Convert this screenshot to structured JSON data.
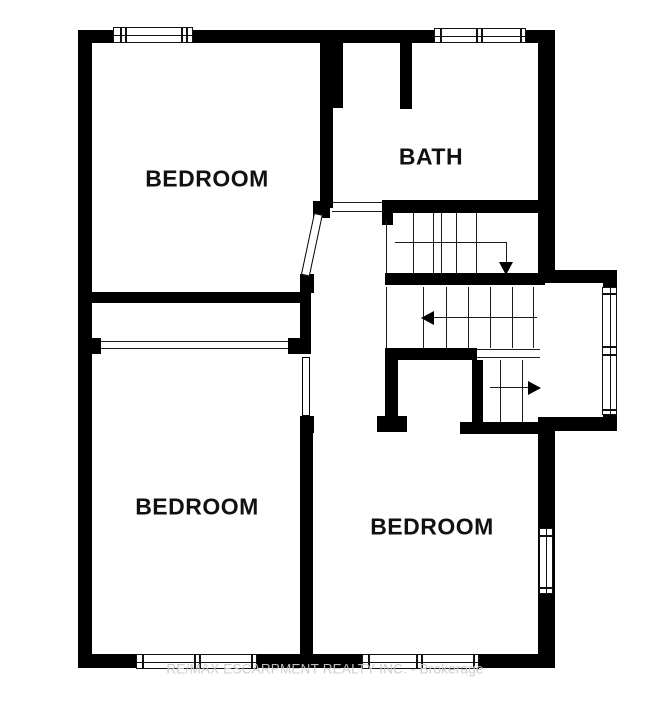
{
  "meta": {
    "kind": "real-estate floor plan",
    "canvas": {
      "width": 650,
      "height": 703
    }
  },
  "colors": {
    "wall": "#000000",
    "background": "#ffffff",
    "thin_line": "#1c1c1c",
    "watermark": "#c9c9c9"
  },
  "labels": {
    "rooms": [
      {
        "id": "bedroom-top-left",
        "text": "BEDROOM",
        "cx": 207,
        "cy": 179
      },
      {
        "id": "bath",
        "text": "BATH",
        "cx": 431,
        "cy": 157
      },
      {
        "id": "bedroom-bottom-left",
        "text": "BEDROOM",
        "cx": 197,
        "cy": 507
      },
      {
        "id": "bedroom-bottom-right",
        "text": "BEDROOM",
        "cx": 432,
        "cy": 527
      }
    ]
  },
  "watermark": {
    "text": "RE/MAX ESCARPMENT REALTY INC. - Brokerage",
    "cx": 325,
    "cy": 669
  },
  "geometry": {
    "walls": [
      [
        78,
        30,
        477,
        13
      ],
      [
        78,
        30,
        14,
        638
      ],
      [
        78,
        654,
        477,
        14
      ],
      [
        538,
        30,
        17,
        253
      ],
      [
        552,
        270,
        65,
        13
      ],
      [
        603,
        283,
        14,
        147
      ],
      [
        538,
        417,
        79,
        14
      ],
      [
        538,
        430,
        17,
        238
      ],
      [
        320,
        43,
        23,
        65
      ],
      [
        320,
        108,
        13,
        100
      ],
      [
        313,
        201,
        17,
        17
      ],
      [
        300,
        274,
        14,
        19
      ],
      [
        92,
        292,
        219,
        11
      ],
      [
        300,
        303,
        11,
        51
      ],
      [
        92,
        338,
        9,
        16
      ],
      [
        288,
        338,
        22,
        16
      ],
      [
        300,
        416,
        14,
        17
      ],
      [
        300,
        433,
        13,
        221
      ],
      [
        400,
        43,
        12,
        66
      ],
      [
        382,
        200,
        161,
        13
      ],
      [
        382,
        205,
        11,
        20
      ],
      [
        385,
        273,
        160,
        12
      ],
      [
        385,
        348,
        92,
        12
      ],
      [
        385,
        360,
        13,
        62
      ],
      [
        377,
        416,
        30,
        16
      ],
      [
        472,
        360,
        11,
        67
      ],
      [
        460,
        422,
        85,
        12
      ]
    ],
    "thin_lines": [
      [
        101,
        341,
        187,
        1
      ],
      [
        101,
        348,
        187,
        1
      ],
      [
        332,
        202,
        50,
        1
      ],
      [
        332,
        211,
        50,
        1
      ],
      [
        386,
        220,
        1,
        53
      ],
      [
        413,
        212,
        1,
        61
      ],
      [
        433,
        212,
        1,
        61
      ],
      [
        441,
        212,
        1,
        61
      ],
      [
        456,
        212,
        1,
        61
      ],
      [
        476,
        212,
        1,
        61
      ],
      [
        395,
        242,
        112,
        1
      ],
      [
        506,
        243,
        1,
        20
      ],
      [
        386,
        287,
        1,
        61
      ],
      [
        423,
        287,
        1,
        61
      ],
      [
        446,
        287,
        1,
        61
      ],
      [
        468,
        287,
        1,
        61
      ],
      [
        490,
        287,
        1,
        61
      ],
      [
        512,
        287,
        1,
        61
      ],
      [
        533,
        287,
        1,
        61
      ],
      [
        432,
        317,
        105,
        1
      ],
      [
        477,
        349,
        63,
        1
      ],
      [
        477,
        357,
        63,
        1
      ],
      [
        500,
        360,
        1,
        62
      ],
      [
        522,
        360,
        1,
        62
      ],
      [
        490,
        387,
        38,
        1
      ]
    ],
    "windows": [
      {
        "name": "window-top-left-bedroom",
        "x": 113,
        "y": 27,
        "w": 80,
        "h": 16,
        "orient": "h",
        "bars": [
          6,
          11,
          67,
          72
        ]
      },
      {
        "name": "window-bath",
        "x": 434,
        "y": 28,
        "w": 92,
        "h": 15,
        "orient": "h",
        "bars": [
          5,
          41,
          46,
          85
        ]
      },
      {
        "name": "window-bottom-left-bedroom",
        "x": 136,
        "y": 654,
        "w": 121,
        "h": 15,
        "orient": "h",
        "bars": [
          5,
          57,
          62,
          114
        ]
      },
      {
        "name": "window-bottom-right-bedroom",
        "x": 362,
        "y": 654,
        "w": 117,
        "h": 15,
        "orient": "h",
        "bars": [
          5,
          53,
          58,
          110
        ]
      },
      {
        "name": "window-stair-landing",
        "x": 602,
        "y": 287,
        "w": 15,
        "h": 128,
        "orient": "v",
        "bars": [
          5,
          58,
          66,
          121
        ]
      },
      {
        "name": "window-right-bedroom",
        "x": 539,
        "y": 528,
        "w": 14,
        "h": 66,
        "orient": "v",
        "bars": [
          6,
          58
        ]
      }
    ],
    "doors": [
      {
        "name": "door-top-left-bedroom",
        "x": 314,
        "y": 213,
        "w": 9,
        "h": 63,
        "rotate": 12
      },
      {
        "name": "door-bottom-left-bedroom",
        "x": 302,
        "y": 357,
        "w": 8,
        "h": 59,
        "rotate": 0
      }
    ],
    "arrows": [
      {
        "name": "stair-arrow-down",
        "x": 499,
        "y": 262,
        "dir": "down"
      },
      {
        "name": "stair-arrow-left",
        "x": 421,
        "y": 311,
        "dir": "left"
      },
      {
        "name": "stair-arrow-right",
        "x": 528,
        "y": 381,
        "dir": "right"
      }
    ]
  }
}
